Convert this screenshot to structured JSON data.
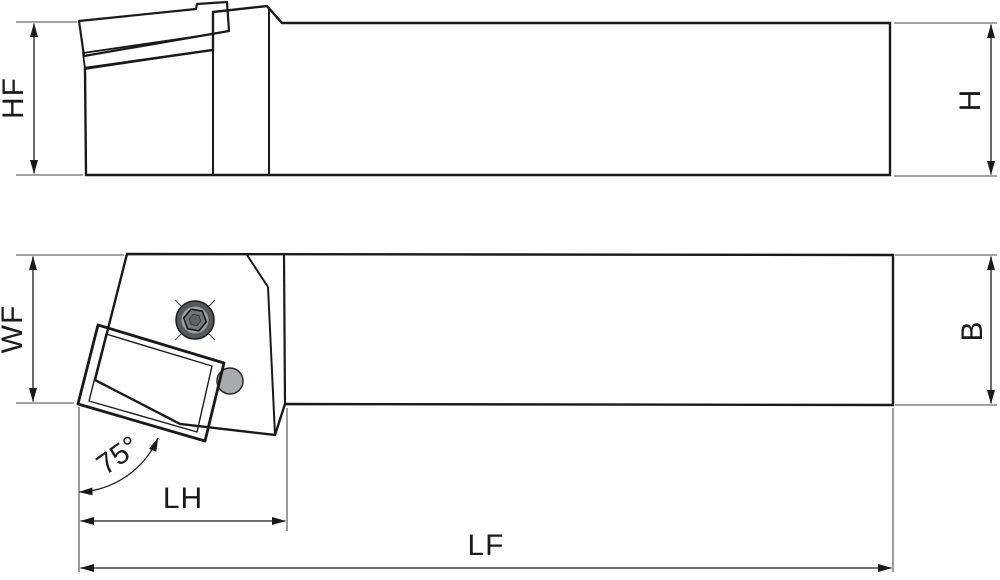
{
  "drawing": {
    "side_view": {
      "labels": {
        "hf": "HF",
        "h": "H"
      }
    },
    "plan_view": {
      "labels": {
        "wf": "WF",
        "b": "B",
        "lh": "LH",
        "lf": "LF",
        "approach_angle": "75°"
      }
    }
  },
  "colors": {
    "background": "#ffffff",
    "body_gray": "#d4d6d8",
    "insert_orange": "#f5a712",
    "shim_gray": "#9b9ea1",
    "outline_black": "#1a1a1a",
    "screw_outer_dark": "#53585c",
    "screw_mid_gray": "#9ca1a4",
    "screw_hex_gray": "#74797d",
    "screw_hex_inner": "#5d6265",
    "pin_gray": "#a6abae"
  }
}
